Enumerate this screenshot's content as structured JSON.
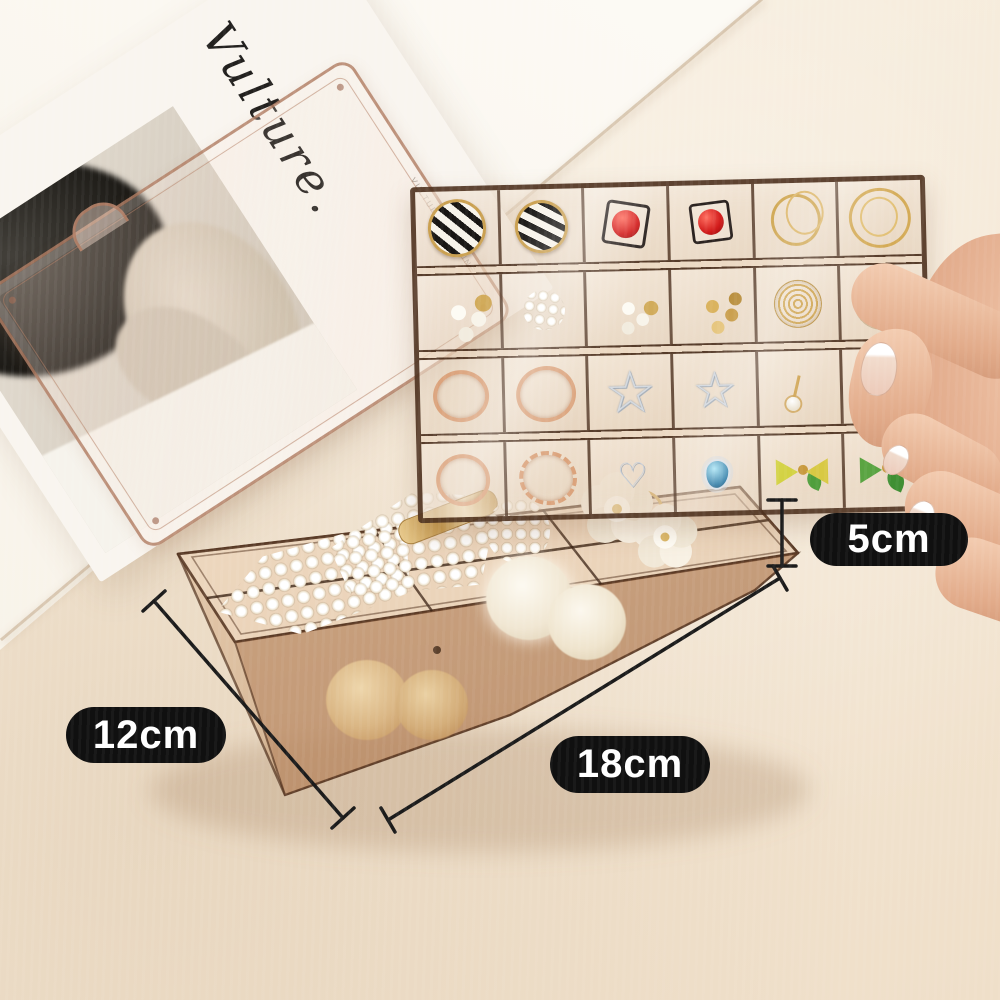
{
  "annotation": {
    "height_label": "5cm",
    "width_label": "12cm",
    "length_label": "18cm",
    "label_background": "#101010",
    "label_text_color": "#ffffff",
    "line_color": "#1b1b1b"
  },
  "magazine": {
    "masthead": "Vulture.",
    "side_text": "VULTURE MAGAZINE"
  },
  "scene": {
    "background_color": "#f5ebdb",
    "surface": "cream tabletop",
    "box_color": "#a97c54",
    "box_style": "translucent amber acrylic jewelry organizer",
    "held_by": "hand holding earring tray at right edge"
  },
  "tray": {
    "rows": 4,
    "columns": 6,
    "compartments": [
      "black-white-striped-hoop-earring",
      "black-white-striped-hoop-earring",
      "red-bead-square-earring",
      "red-bead-square-earring",
      "gold-hoop-earrings",
      "gold-hoop-earrings",
      "pearl-stud-earrings",
      "pearl-cluster-earrings",
      "pearl-and-gold-studs",
      "gold-knot-studs",
      "gold-wire-ball-earring",
      "gold-wire-ball-earring",
      "rose-gold-ring",
      "rose-gold-ring",
      "silver-star-earring",
      "silver-star-earring",
      "gold-pearl-dangle-earring",
      "gold-cluster-earring",
      "rose-gold-ring",
      "rose-gold-twisted-ring",
      "silver-heart-earrings",
      "blue-crystal-earring",
      "green-bow-earring",
      "green-bow-earring"
    ]
  },
  "box_items": [
    "pearl-triangle-barrette",
    "pearl-triangle-barrette",
    "gold-bar-hair-clip",
    "round-pearl-cluster-clip",
    "gold-wire-loop",
    "white-flower-hair-tie",
    "white-flower-hair-tie",
    "white-fur-pompom",
    "white-fur-pompom",
    "tan-fur-scrunchie",
    "tan-fur-scrunchie"
  ]
}
